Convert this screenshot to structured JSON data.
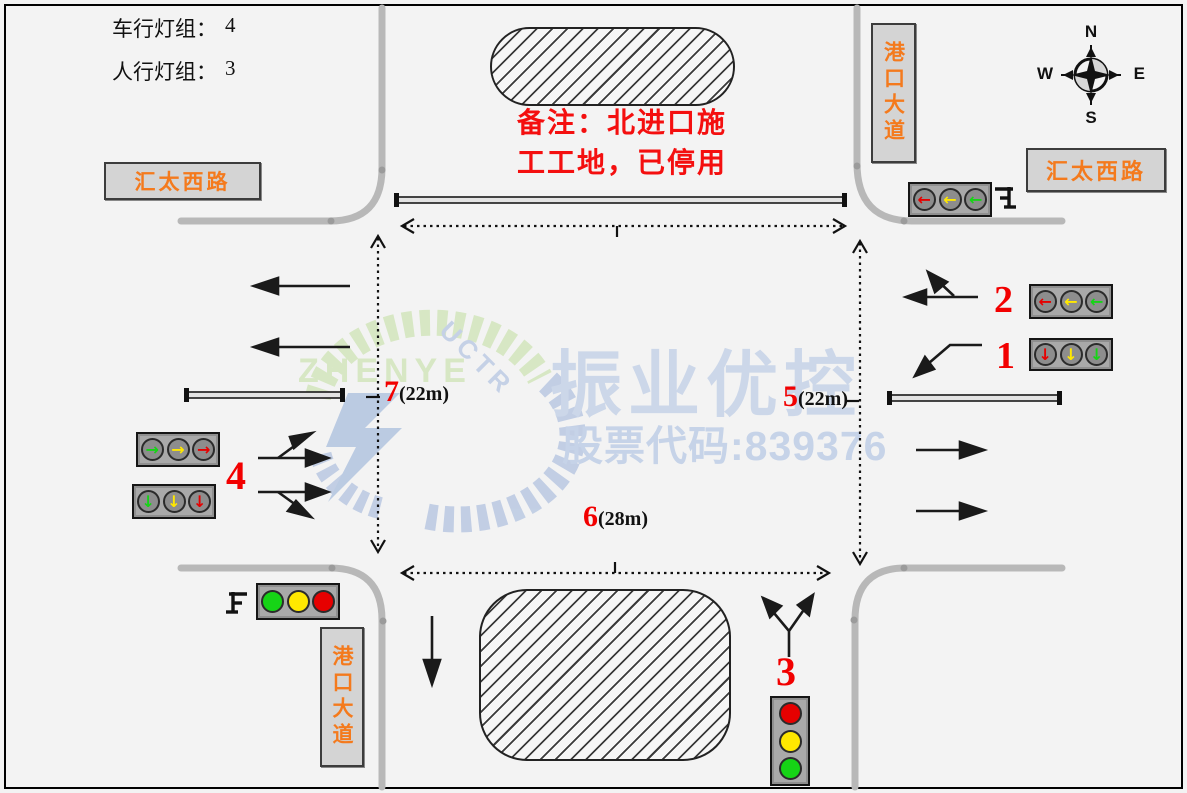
{
  "stats": {
    "vehicle_label": "车行灯组：",
    "vehicle_value": "4",
    "ped_label": "人行灯组：",
    "ped_value": "3"
  },
  "note": {
    "line1": "备注：北进口施",
    "line2": "工工地，已停用"
  },
  "roads": {
    "west": "汇太西路",
    "east": "汇太西路",
    "north": "港口大道",
    "south": "港口大道"
  },
  "compass": {
    "north": "N",
    "south": "S",
    "east": "E",
    "west": "W"
  },
  "watermark": {
    "brand": "振业优控",
    "stock_line": "股票代码:839376",
    "logo_text": "ZHENYE",
    "logo_sub": "UCTR"
  },
  "measures": {
    "m7": {
      "num": "7",
      "dim": "(22m)"
    },
    "m5": {
      "num": "5",
      "dim": "(22m)"
    },
    "m6": {
      "num": "6",
      "dim": "(28m)"
    }
  },
  "signals": {
    "s1": {
      "number": "1",
      "glyph": "↓",
      "lamps": [
        "red",
        "yellow",
        "green"
      ]
    },
    "s2": {
      "number": "2",
      "glyph": "←",
      "lamps": [
        "red",
        "yellow",
        "green"
      ]
    },
    "s3": {
      "number": "3",
      "solid": true,
      "lamps": [
        "red",
        "yellow",
        "green"
      ]
    },
    "s4": {
      "number": "4"
    },
    "s4a": {
      "glyph": "→",
      "lamps": [
        "green",
        "yellow",
        "red"
      ]
    },
    "s4b": {
      "glyph": "↓",
      "lamps": [
        "green",
        "yellow",
        "red"
      ]
    },
    "east_approach": {
      "glyph": "←",
      "lamps": [
        "red",
        "yellow",
        "green"
      ]
    },
    "south_west": {
      "solid": true,
      "lamps": [
        "green",
        "yellow",
        "red"
      ]
    }
  },
  "colors": {
    "background": "#f3f3f3",
    "curb_gray": "#b8b8b8",
    "road_label_orange": "#f47a1d",
    "note_red": "#f40f0f",
    "number_red": "#f20000",
    "lamp_red": "#e60000",
    "lamp_yellow": "#ffe800",
    "lamp_green": "#16d416",
    "watermark_blue": "#ccd7e9",
    "logo_green": "#d6e7c2"
  }
}
